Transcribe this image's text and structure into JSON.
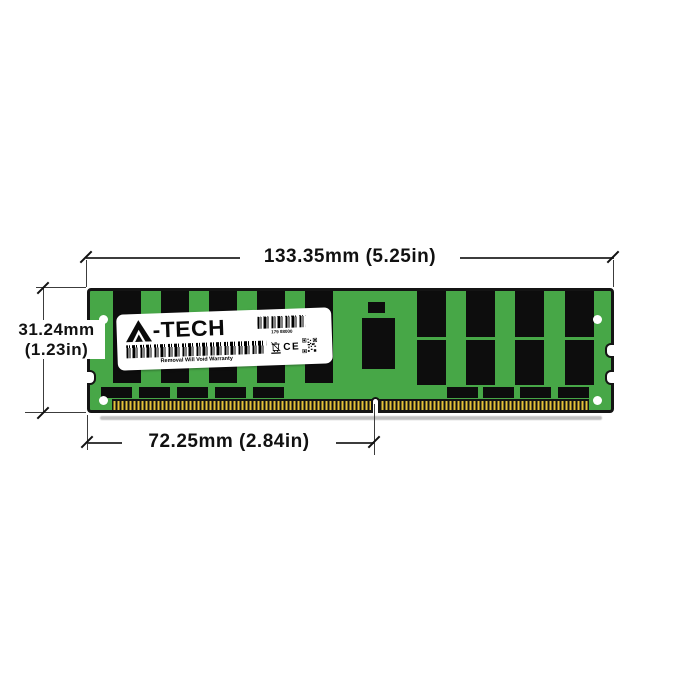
{
  "annotations": {
    "width_dimension": "133.35mm (5.25in)",
    "height_dimension_mm": "31.24mm",
    "height_dimension_in": "(1.23in)",
    "key_notch_dimension": "72.25mm (2.84in)"
  },
  "module": {
    "brand": "A-TECH",
    "label": {
      "logo_suffix": "-TECH",
      "serial_number": "179 88000",
      "warranty_text": "Removal Will Void Warranty",
      "ce_mark": "CE"
    },
    "colors": {
      "pcb_green": "#47a747",
      "chip_black": "#0d0d0d",
      "pin_gold": "#e4c23a",
      "outline_black": "#141414"
    }
  }
}
